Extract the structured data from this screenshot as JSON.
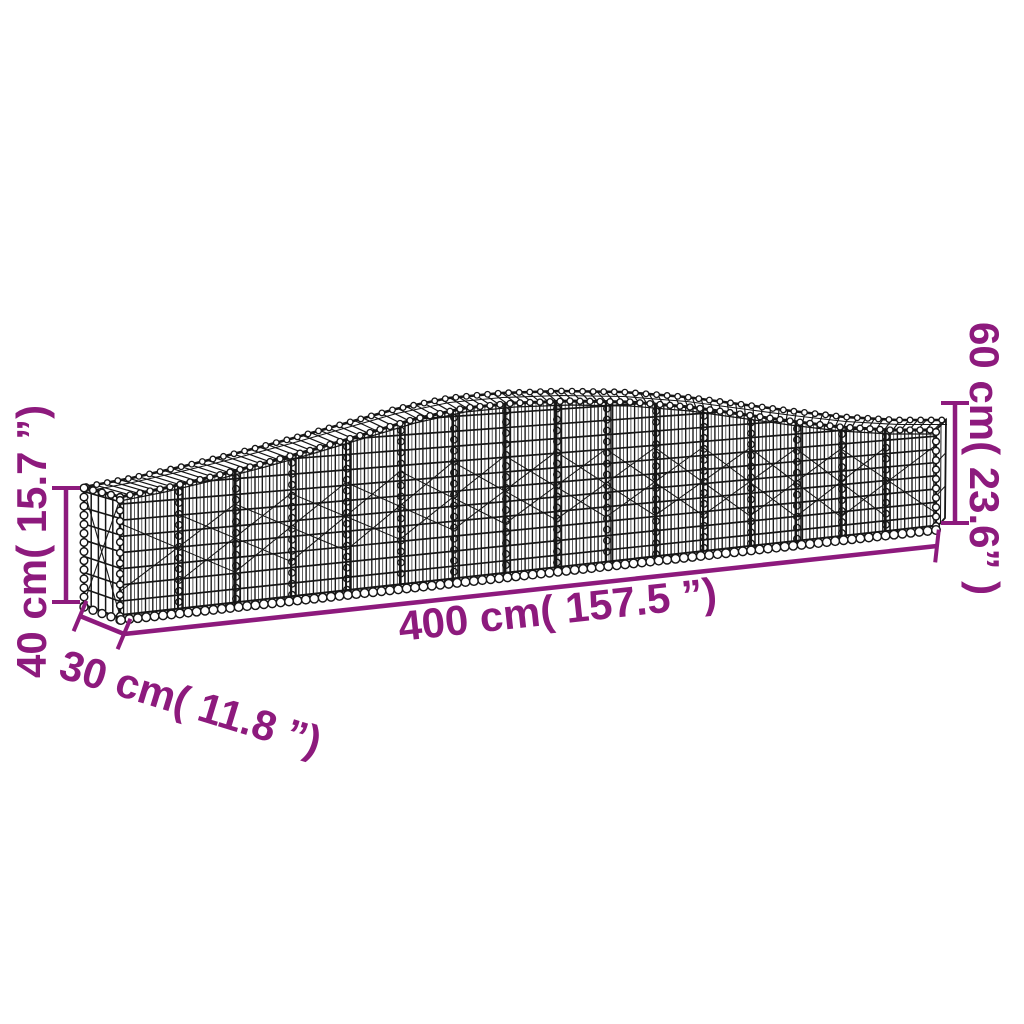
{
  "page": {
    "background": "#ffffff",
    "type": "product-dimension-diagram",
    "subject": "arched gabion wire mesh basket"
  },
  "illustration": {
    "wire_color": "#161616",
    "accent_color": "#8d1a7d"
  },
  "dimensions": {
    "length": "400 cm( 157.5 ”)",
    "depth": "30 cm( 11.8 ”)",
    "end_height": "40 cm( 15.7 ”)",
    "middle_height": "60 cm( 23.6” )"
  }
}
